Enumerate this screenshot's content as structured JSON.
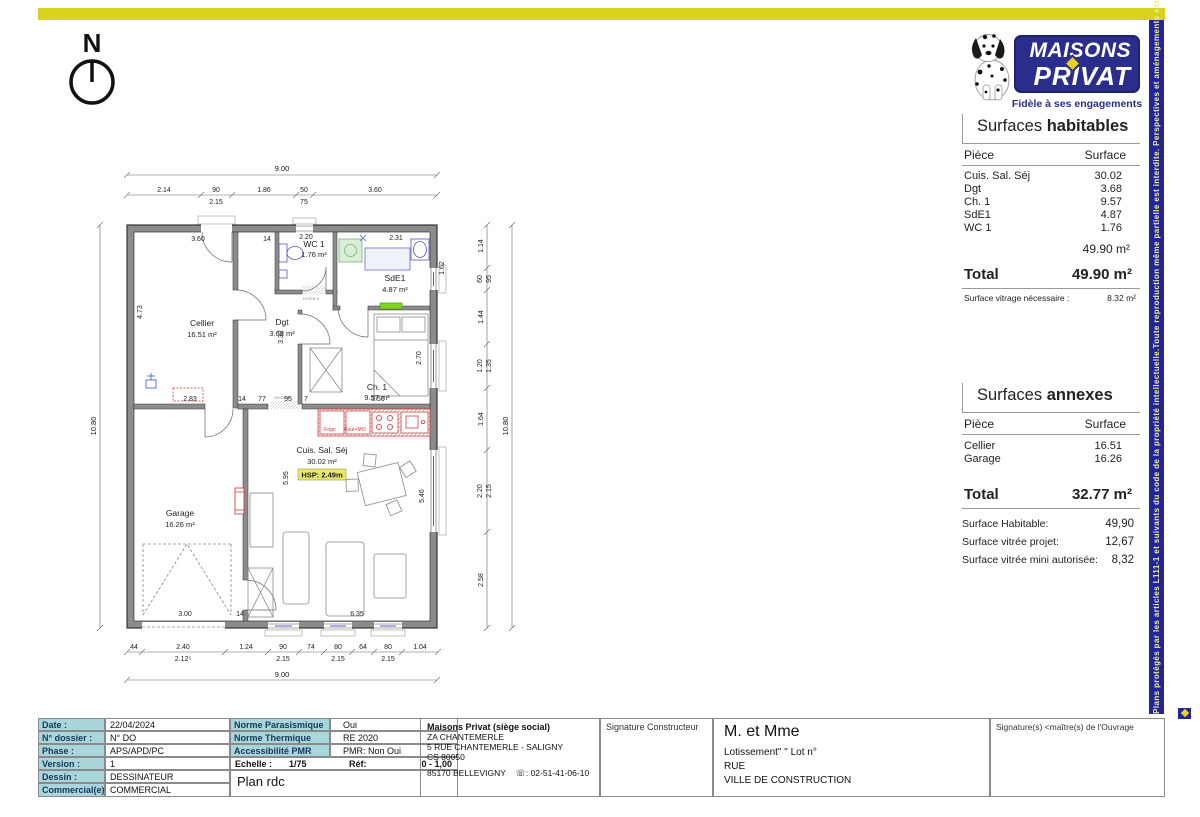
{
  "page": {
    "side_note": "Plans protégés par les articles L111-1 et suivants du code de la propriété intellectuelle.Toute reproduction même partielle est interdite. Perspectives et aménagements extérieurs sont non contractuels"
  },
  "logo": {
    "line1": "MAISONS",
    "line2": "PRIVAT",
    "tagline": "Fidèle à ses engagements"
  },
  "north": {
    "label": "N"
  },
  "surfaces_habitables": {
    "title_prefix": "Surfaces ",
    "title_bold": "habitables",
    "col_piece": "Pièce",
    "col_surface": "Surface",
    "rows": [
      {
        "piece": "Cuis. Sal. Séj",
        "surface": "30.02"
      },
      {
        "piece": "Dgt",
        "surface": "3.68"
      },
      {
        "piece": "Ch. 1",
        "surface": "9.57"
      },
      {
        "piece": "SdE1",
        "surface": "4.87"
      },
      {
        "piece": "WC 1",
        "surface": "1.76"
      }
    ],
    "subtotal": "49.90 m²",
    "total_label": "Total",
    "total_value": "49.90 m²",
    "note_label": "Surface vitrage nécessaire :",
    "note_value": "8.32 m²"
  },
  "surfaces_annexes": {
    "title_prefix": "Surfaces ",
    "title_bold": "annexes",
    "col_piece": "Pièce",
    "col_surface": "Surface",
    "rows": [
      {
        "piece": "Cellier",
        "surface": "16.51"
      },
      {
        "piece": "Garage",
        "surface": "16.26"
      }
    ],
    "total_label": "Total",
    "total_value": "32.77 m²"
  },
  "summary": {
    "rows": [
      {
        "label": "Surface Habitable:",
        "value": "49,90"
      },
      {
        "label": "Surface vitrée projet:",
        "value": "12,67"
      },
      {
        "label": "Surface vitrée mini autorisée:",
        "value": "8,32"
      }
    ]
  },
  "plan": {
    "overall_w": "9.00",
    "overall_h": "10.80",
    "top": [
      "2.14",
      "90",
      "2.15",
      "1.86",
      "50",
      "75",
      "3.60"
    ],
    "right": [
      "1.14",
      "60",
      "95",
      "1.44",
      "1.20",
      "1.35",
      "1.64",
      "2.20",
      "2.15",
      "2.58"
    ],
    "bottom": [
      "44",
      "2.40",
      "2.12⁵",
      "1.24",
      "90",
      "2.15",
      "74",
      "80",
      "2.15",
      "64",
      "80",
      "2.15",
      "1.04"
    ],
    "inner": [
      "3.60",
      "14",
      "4.73",
      "2.83",
      "14",
      "77",
      "95",
      "7",
      "3.56",
      "2.20",
      "2.31",
      "1.62",
      "3.32",
      "2.70",
      "5.95",
      "5.46",
      "3.00",
      "14",
      "6.35"
    ],
    "rooms": {
      "cellier": {
        "name": "Cellier",
        "area": "16.51 m²"
      },
      "wc": {
        "name": "WC 1",
        "area": "1.76 m²"
      },
      "sde": {
        "name": "SdE1",
        "area": "4.87 m²"
      },
      "dgt": {
        "name": "Dgt",
        "area": "3.68 m²"
      },
      "ch1": {
        "name": "Ch. 1",
        "area": "9.57 m²"
      },
      "sejour": {
        "name": "Cuis. Sal. Séj",
        "area": "30.02 m²"
      },
      "garage": {
        "name": "Garage",
        "area": "16.26 m²"
      }
    },
    "notes": {
      "hsp": "HSP: 2.49m",
      "frigo": "Frigo",
      "four": "Four+MO",
      "door1": "HO/EB d",
      "door2": "HO/EB d"
    }
  },
  "titleblock": {
    "info_rows": [
      {
        "label": "Date :",
        "value": "22/04/2024"
      },
      {
        "label": "N° dossier :",
        "value": "N° DO"
      },
      {
        "label": "Phase :",
        "value": "APS/APD/PC"
      },
      {
        "label": "Version :",
        "value": "1"
      },
      {
        "label": "Dessin :",
        "value": "DESSINATEUR"
      },
      {
        "label": "Commercial(e) :",
        "value": "COMMERCIAL"
      }
    ],
    "normes_rows": [
      {
        "label": "Norme Parasismique",
        "value": "Oui"
      },
      {
        "label": "Norme Thermique",
        "value": "RE 2020"
      },
      {
        "label": "Accessibilité PMR",
        "value": "PMR:  Non Oui"
      }
    ],
    "echelle_label": "Echelle :",
    "echelle_value": "1/75",
    "ref_label": "Réf:",
    "ref_value": "0 - 1,00",
    "plan_title": "Plan rdc",
    "company_name": "Maisons Privat (siège social)",
    "company_lines": [
      "ZA CHANTEMERLE",
      "5 RUE CHANTEMERLE - SALIGNY",
      "CS 80050"
    ],
    "company_city": "85170 BELLEVIGNY",
    "company_phone": "☏: 02-51-41-06-10",
    "sig_constructeur": "Signature Constructeur",
    "client_title": "M. et Mme",
    "client_lines": [
      "Lotissement\"   \" Lot n°",
      "RUE",
      "VILLE DE CONSTRUCTION"
    ],
    "sig_owner": "Signature(s) <maître(s) de l'Ouvrage"
  }
}
